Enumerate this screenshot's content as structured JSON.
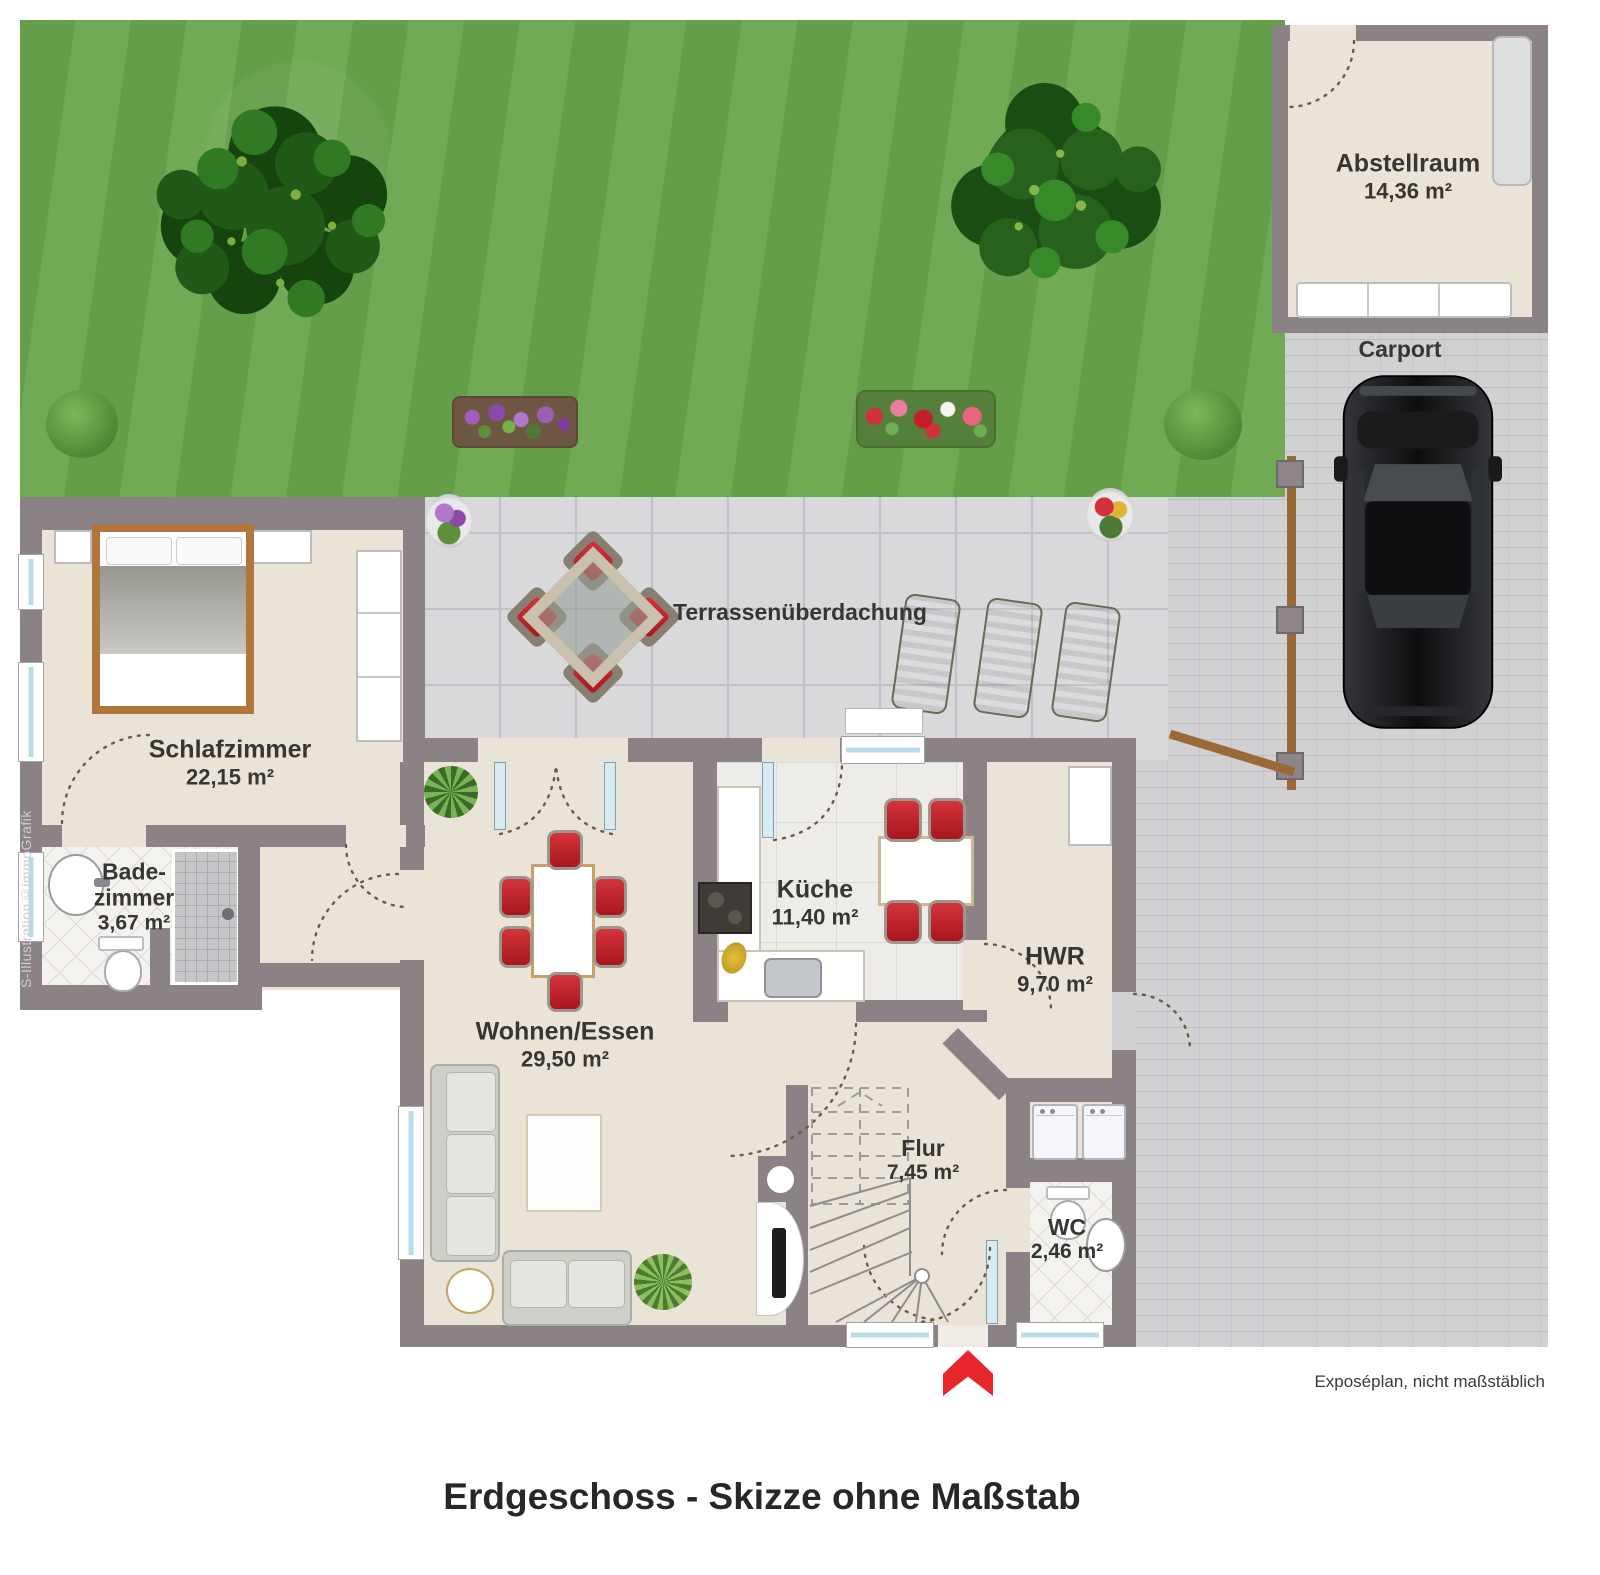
{
  "texts": {
    "title": "Erdgeschoss - Skizze ohne Maßstab",
    "footnote": "Exposéplan, nicht maßstäblich",
    "watermark": "S-Illustration©immoGrafik"
  },
  "rooms": {
    "abstellraum": {
      "name": "Abstellraum",
      "area": "14,36 m²"
    },
    "carport": {
      "name": "Carport"
    },
    "terrasse": {
      "name": "Terrassenüberdachung"
    },
    "schlafzimmer": {
      "name": "Schlafzimmer",
      "area": "22,15 m²"
    },
    "badezimmer": {
      "name_line1": "Bade-",
      "name_line2": "zimmer",
      "area": "3,67 m²"
    },
    "wohnen": {
      "name": "Wohnen/Essen",
      "area": "29,50 m²"
    },
    "kueche": {
      "name": "Küche",
      "area": "11,40 m²"
    },
    "hwr": {
      "name": "HWR",
      "area": "9,70 m²"
    },
    "flur": {
      "name": "Flur",
      "area": "7,45 m²"
    },
    "wc": {
      "name": "WC",
      "area": "2,46 m²"
    }
  },
  "colors": {
    "wall": "#8b8286",
    "floor": "#eae4d8",
    "grass": "#68a54c",
    "terrace": "#d9d9db",
    "paving": "#d1d1d4",
    "window_glass": "#bfe0ec",
    "accent_red": "#e8252b",
    "wood": "#9a6a36",
    "chair_red": "#c6232a"
  }
}
